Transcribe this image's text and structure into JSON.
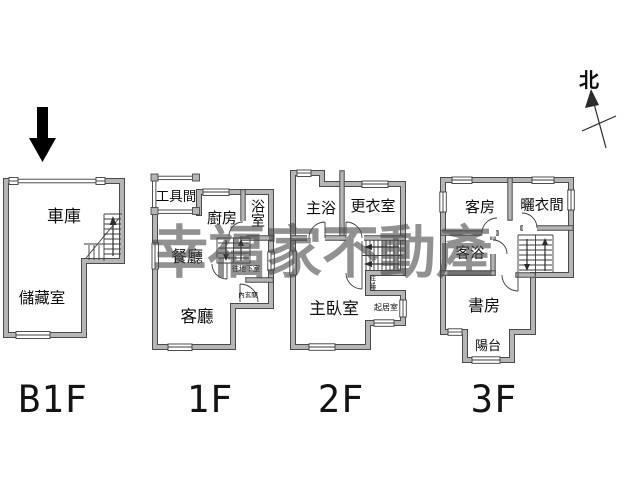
{
  "watermark": "幸福家不動產",
  "compass_label": "北",
  "floors": [
    {
      "label": "B1F",
      "rooms": {
        "garage": "車庫",
        "storage": "儲藏室"
      }
    },
    {
      "label": "1F",
      "rooms": {
        "tool_room": "工具間",
        "kitchen": "廚房",
        "bath": "浴室",
        "dining": "餐廳",
        "living": "客廳"
      },
      "annotations": {
        "to_basement": "往地下室",
        "inner_foyer": "內玄關"
      }
    },
    {
      "label": "2F",
      "rooms": {
        "master_bath": "主浴",
        "dressing_room": "更衣室",
        "master_bedroom": "主臥室",
        "sitting_room": "起居室"
      },
      "annotations": {
        "to_3f": "往3樓"
      }
    },
    {
      "label": "3F",
      "rooms": {
        "guest_room": "客房",
        "drying_room": "曬衣間",
        "guest_bath": "客浴",
        "study": "書房",
        "balcony": "陽台"
      }
    }
  ]
}
